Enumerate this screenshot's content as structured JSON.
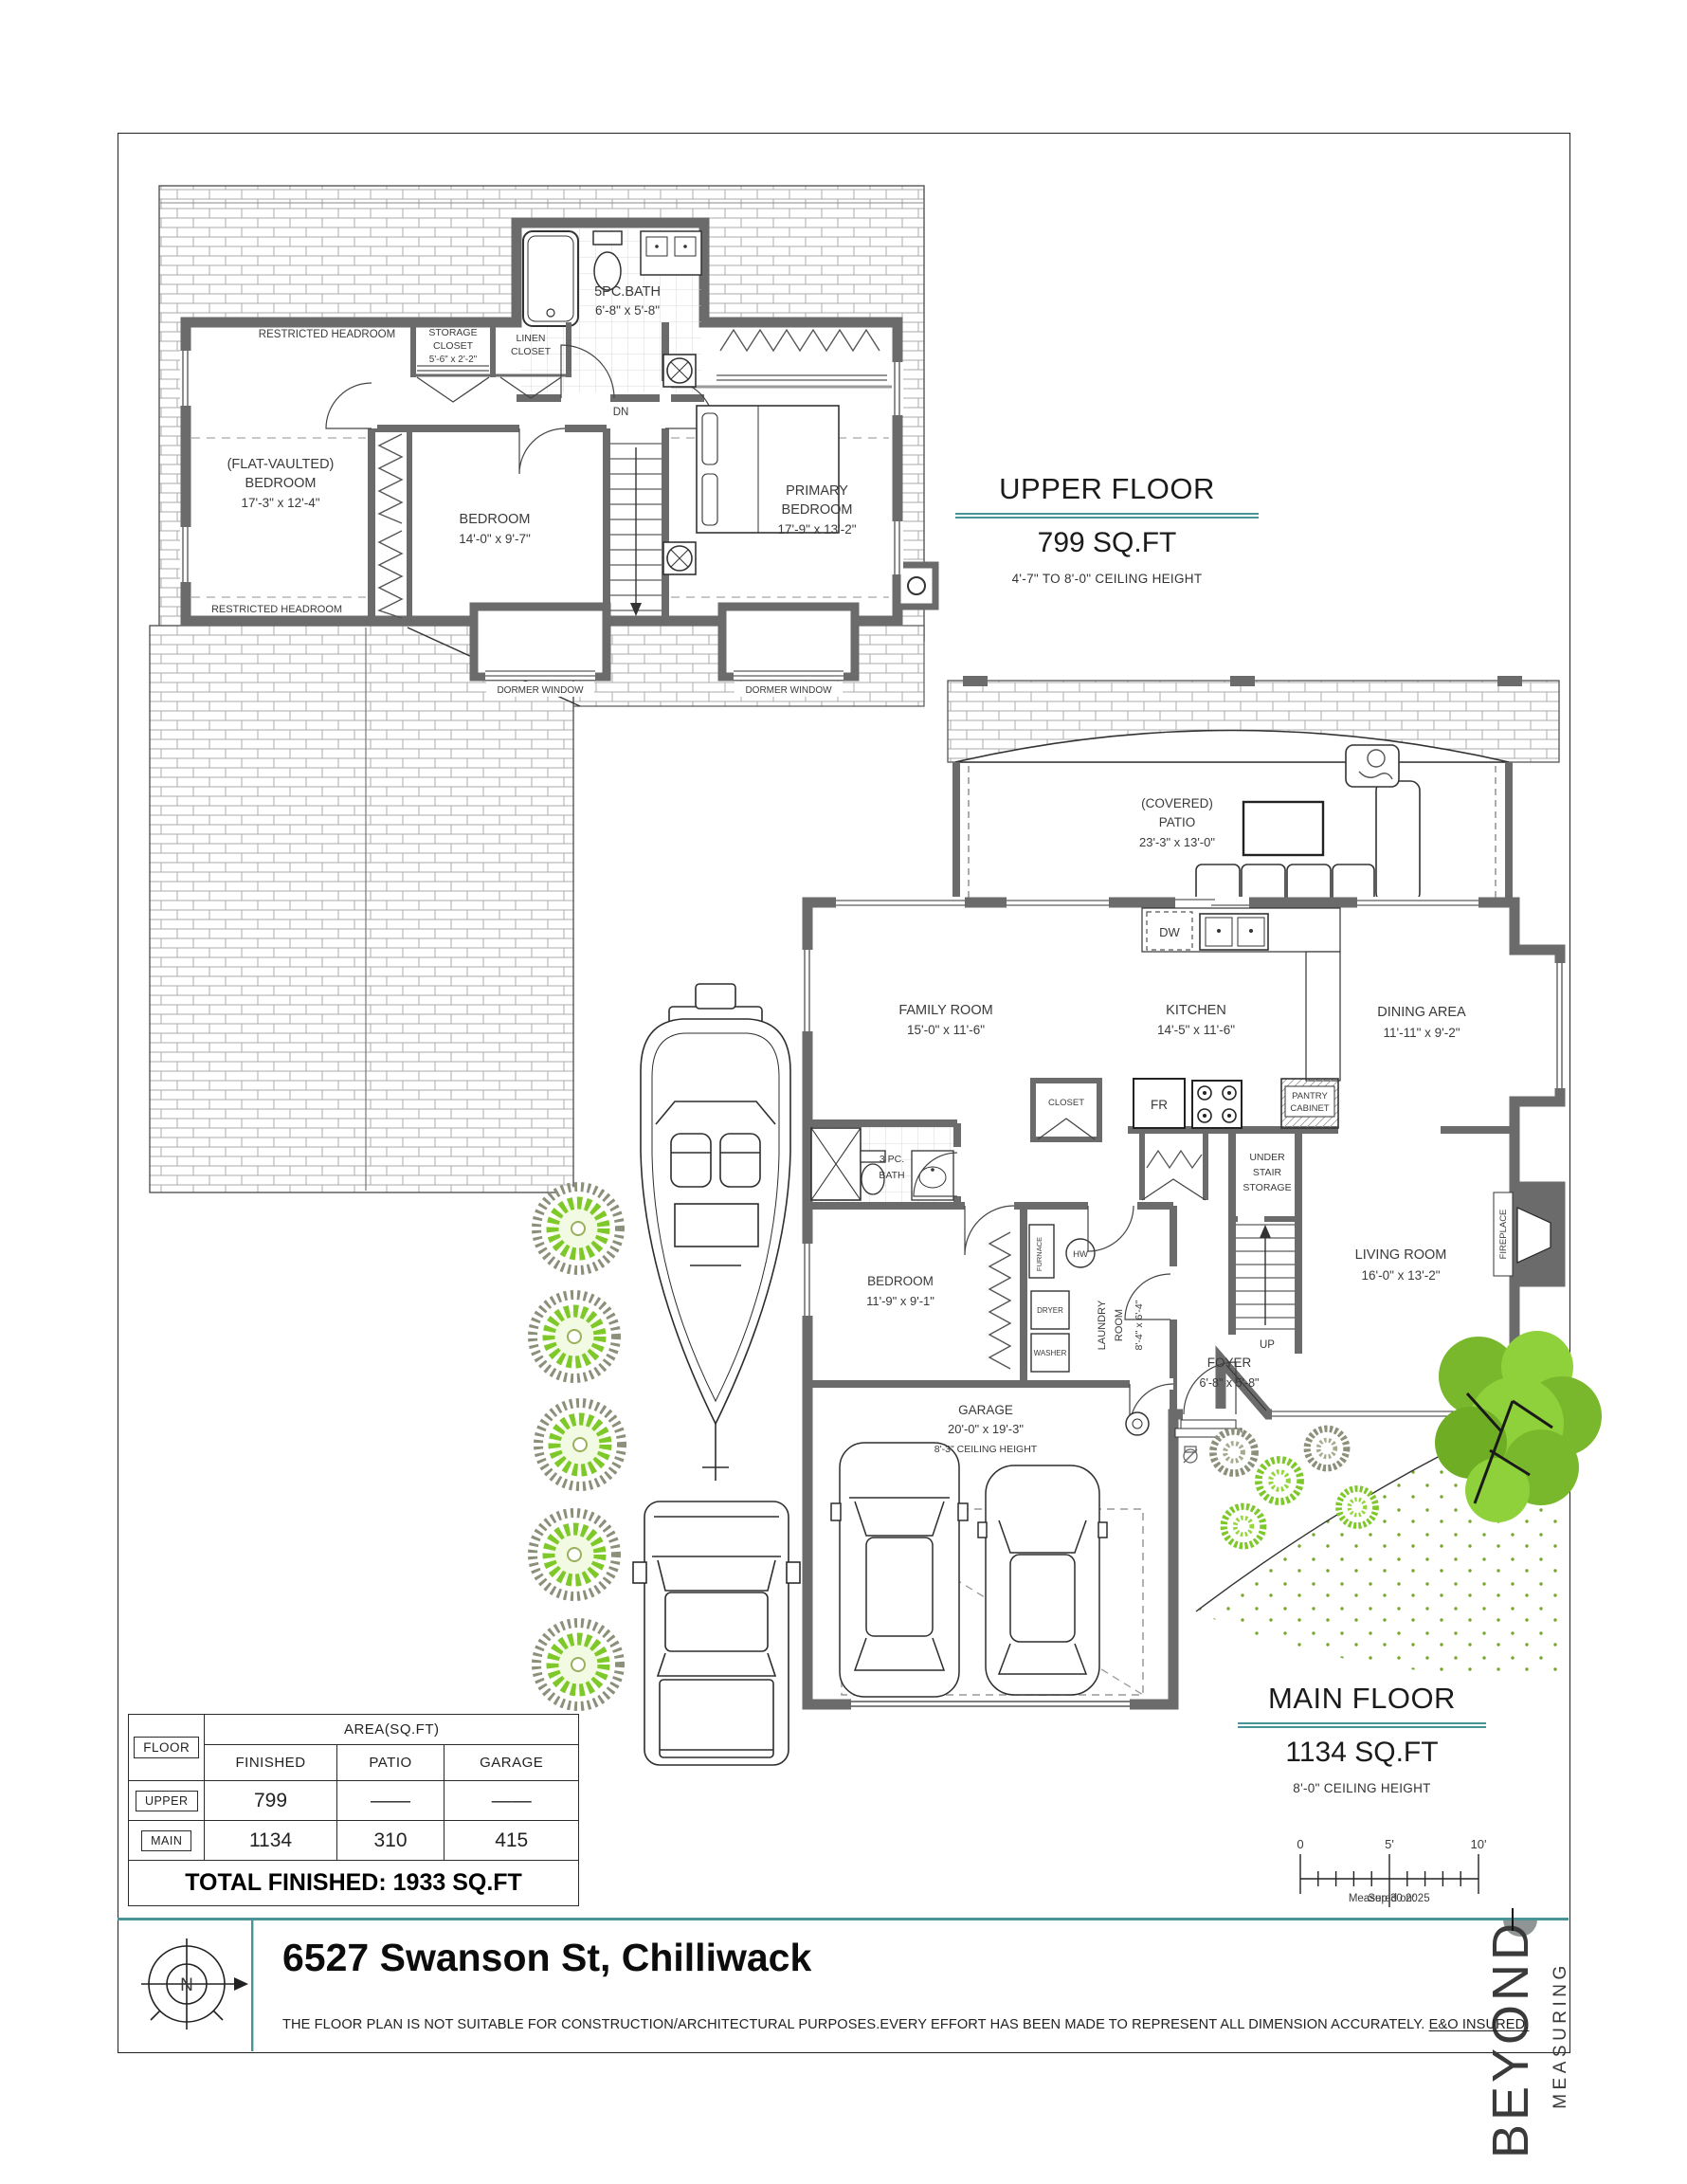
{
  "colors": {
    "teal": "#4a9397",
    "wall": "#6b6b6b",
    "shrub_green": "#7ec82a",
    "tree_green": "#79b82c"
  },
  "upper": {
    "title": "UPPER FLOOR",
    "area": "799 SQ.FT",
    "ceiling": "4'-7\" TO 8'-0\" CEILING HEIGHT",
    "labels": {
      "restricted_top": "RESTRICTED HEADROOM",
      "restricted_bottom": "RESTRICTED HEADROOM",
      "storage1": "STORAGE",
      "storage2": "CLOSET",
      "storage3": "5'-6\" x 2'-2\"",
      "linen1": "LINEN",
      "linen2": "CLOSET",
      "bath1": "5PC.BATH",
      "bath2": "6'-8\" x 5'-8\"",
      "dn": "DN",
      "flat1": "(FLAT-VAULTED)",
      "flat2": "BEDROOM",
      "flat3": "17'-3\" x 12'-4\"",
      "bed1": "BEDROOM",
      "bed2": "14'-0\" x 9'-7\"",
      "pri1": "PRIMARY",
      "pri2": "BEDROOM",
      "pri3": "17'-9\" x 13'-2\"",
      "dormer": "DORMER WINDOW"
    }
  },
  "main": {
    "title": "MAIN FLOOR",
    "area": "1134 SQ.FT",
    "ceiling": "8'-0\" CEILING HEIGHT",
    "labels": {
      "patio1": "(COVERED)",
      "patio2": "PATIO",
      "patio3": "23'-3\" x 13'-0\"",
      "dw": "DW",
      "family1": "FAMILY ROOM",
      "family2": "15'-0\" x 11'-6\"",
      "kitchen1": "KITCHEN",
      "kitchen2": "14'-5\" x 11'-6\"",
      "dining1": "DINING AREA",
      "dining2": "11'-11\" x 9'-2\"",
      "closet": "CLOSET",
      "fr": "FR",
      "pantry1": "PANTRY",
      "pantry2": "CABINET",
      "under1": "UNDER",
      "under2": "STAIR",
      "under3": "STORAGE",
      "bath1": "3 PC.",
      "bath2": "BATH",
      "bed1": "BEDROOM",
      "bed2": "11'-9\" x 9'-1\"",
      "furnace": "FURNACE",
      "hw": "HW",
      "dryer": "DRYER",
      "washer": "WASHER",
      "laundry1": "LAUNDRY",
      "laundry2": "ROOM",
      "laundry3": "8'-4\" x 6'-4\"",
      "foyer1": "FOYER",
      "foyer2": "6'-8\" x 5'-8\"",
      "up": "UP",
      "living1": "LIVING ROOM",
      "living2": "16'-0\" x 13'-2\"",
      "fireplace": "FIREPLACE",
      "garage1": "GARAGE",
      "garage2": "20'-0\" x 19'-3\"",
      "garage3": "8'-3\" CEILING HEIGHT"
    }
  },
  "table": {
    "floor": "FLOOR",
    "area_header": "AREA(SQ.FT)",
    "col_finished": "FINISHED",
    "col_patio": "PATIO",
    "col_garage": "GARAGE",
    "upper_label": "UPPER",
    "upper_finished": "799",
    "upper_patio": "——",
    "upper_garage": "——",
    "main_label": "MAIN",
    "main_finished": "1134",
    "main_patio": "310",
    "main_garage": "415",
    "total": "TOTAL FINISHED: 1933 SQ.FT"
  },
  "scalebar": {
    "t0": "0",
    "t5": "5'",
    "t10": "10'",
    "measured": "Measured on:",
    "date": "Sep 30  2025"
  },
  "footer": {
    "address": "6527 Swanson St, Chilliwack",
    "disclaimer": "THE  FLOOR PLAN  IS NOT SUITABLE FOR CONSTRUCTION/ARCHITECTURAL PURPOSES.EVERY EFFORT HAS BEEN MADE TO REPRESENT ALL DIMENSION ACCURATELY. ",
    "disclaimer_underline": "E&O INSURED.",
    "compass": "N"
  },
  "logo": {
    "name": "BEYOND",
    "tagline": "MEASURING"
  }
}
